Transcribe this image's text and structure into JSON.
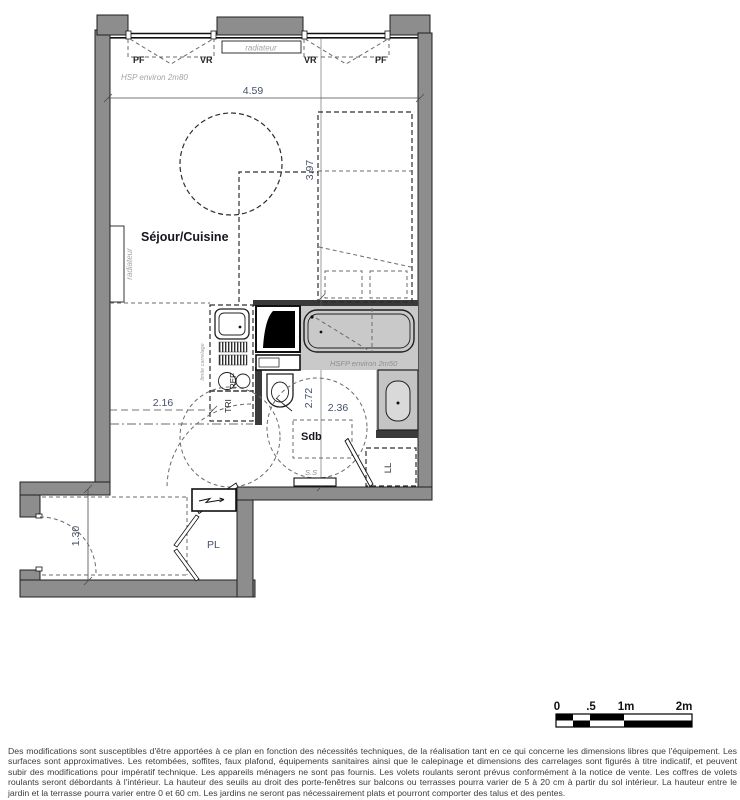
{
  "plan": {
    "room_labels": {
      "living": "Séjour/Cuisine",
      "bathroom": "Sdb",
      "closet": "PL"
    },
    "fixture_labels": {
      "window_left": "PF",
      "shutter_left": "VR",
      "radiator_top": "radiateur",
      "shutter_right": "VR",
      "window_right": "PF",
      "radiator_left": "radiateur",
      "waste_sorting": "TRI",
      "fridge": "REF",
      "washing_machine": "LL",
      "towel_dryer": "S.S",
      "tile_limit": "limite carrelage"
    },
    "annotations": {
      "ceiling_height": "HSP environ 2m80",
      "false_ceiling_height": "HSFP environ 2m50"
    },
    "dimensions": {
      "living_width": "4.59",
      "living_depth": "3.97",
      "kitchen_width": "2.16",
      "bath_depth": "2.72",
      "bath_width": "2.36",
      "entry_width": "1.30"
    },
    "colors": {
      "wall_fill": "#8d8d8d",
      "tile_fill": "#c9c9c9",
      "annotation_text": "#a3a3a3",
      "dimension_text": "#44506b"
    }
  },
  "scale_bar": {
    "tick_0": "0",
    "tick_half": ".5",
    "tick_1": "1m",
    "tick_2": "2m"
  },
  "disclaimer": "Des modifications sont susceptibles d'être apportées à ce plan en fonction des nécessités techniques, de la réalisation tant en ce qui concerne les dimensions libres que l'équipement. Les surfaces sont approximatives. Les retombées, soffites, faux plafond, équipements sanitaires ainsi que le calepinage et dimensions des carrelages sont figurés à titre indicatif, et peuvent subir des modifications pour impératif technique. Les appareils ménagers ne sont pas fournis. Les volets roulants seront prévus conformément à la notice de vente. Les coffres de volets roulants seront débordants à l'intérieur. La hauteur des seuils au droit des porte-fenêtres sur balcons ou terrasses pourra varier de 5 à 20 cm à partir du sol intérieur. La hauteur entre le jardin et la terrasse pourra varier entre 0 et 60 cm. Les jardins ne seront pas nécessairement plats et pourront comporter des talus et des pentes."
}
